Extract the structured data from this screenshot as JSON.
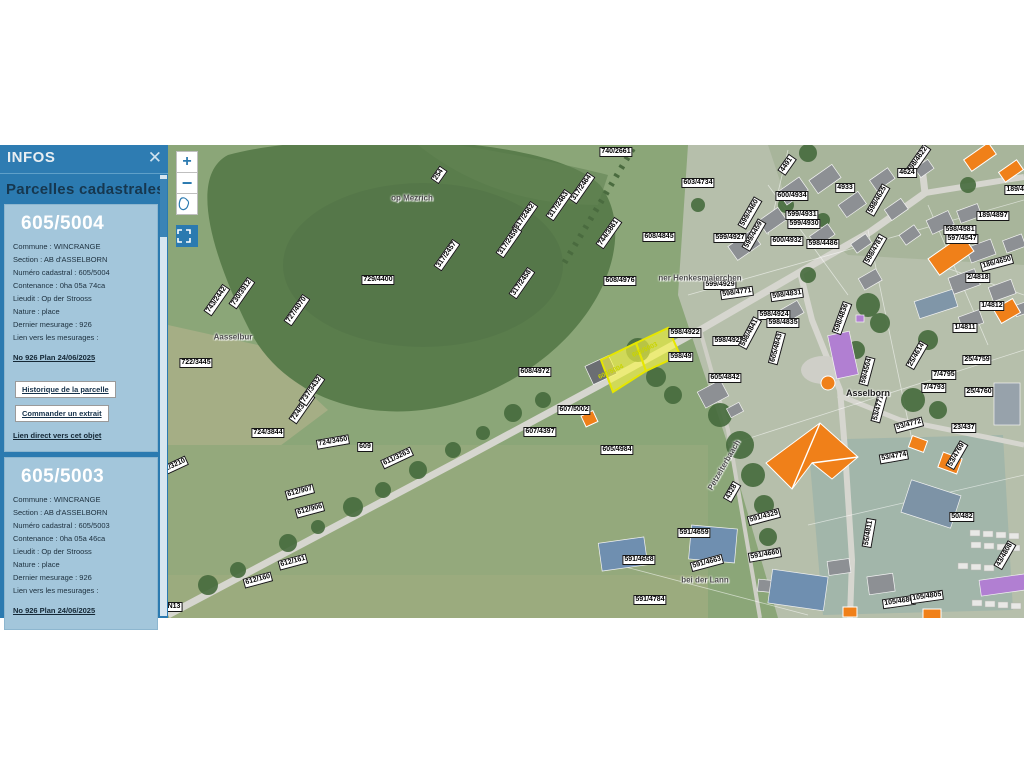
{
  "panel": {
    "header": "INFOS",
    "close_icon": "✕",
    "title": "Parcelles cadastrales",
    "parcels": [
      {
        "id": "605/5004",
        "rows": [
          "Commune : WINCRANGE",
          "Section : AB d'ASSELBORN",
          "Numéro cadastral : 605/5004",
          "Contenance : 0ha 05a 74ca",
          "Lieudit : Op der Strooss",
          "Nature : place",
          "Dernier mesurage : 926",
          "Lien vers les mesurages :"
        ],
        "mesurage_link": "No 926 Plan 24/06/2025",
        "buttons": [
          "Historique de la parcelle",
          "Commander un extrait"
        ],
        "direct_link": "Lien direct vers cet objet"
      },
      {
        "id": "605/5003",
        "rows": [
          "Commune : WINCRANGE",
          "Section : AB d'ASSELBORN",
          "Numéro cadastral : 605/5003",
          "Contenance : 0ha 05a 46ca",
          "Lieudit : Op der Strooss",
          "Nature : place",
          "Dernier mesurage : 926",
          "Lien vers les mesurages :"
        ],
        "mesurage_link": "No 926 Plan 24/06/2025"
      }
    ]
  },
  "map": {
    "controls": {
      "zoom_in": "+",
      "zoom_out": "−"
    },
    "selected_parcels": [
      {
        "label": "605/5004",
        "x": 443,
        "y": 227,
        "r": -25
      },
      {
        "label": "605/5003",
        "x": 477,
        "y": 205,
        "r": -25
      }
    ],
    "labels": [
      {
        "t": "740/2661",
        "x": 448,
        "y": 7,
        "r": 0
      },
      {
        "t": "603/4734",
        "x": 530,
        "y": 38,
        "r": 0
      },
      {
        "t": "608/4845",
        "x": 491,
        "y": 92,
        "r": 0
      },
      {
        "t": "608/4976",
        "x": 452,
        "y": 136,
        "r": 0
      },
      {
        "t": "608/4972",
        "x": 367,
        "y": 227,
        "r": 0
      },
      {
        "t": "607/5002",
        "x": 406,
        "y": 265,
        "r": 0
      },
      {
        "t": "607/4397",
        "x": 372,
        "y": 287,
        "r": 0
      },
      {
        "t": "605/4984",
        "x": 449,
        "y": 305,
        "r": 0
      },
      {
        "t": "605/4842",
        "x": 557,
        "y": 233,
        "r": 0
      },
      {
        "t": "598/4922",
        "x": 517,
        "y": 188,
        "r": 0
      },
      {
        "t": "598/4924",
        "x": 606,
        "y": 170,
        "r": 0
      },
      {
        "t": "598/4925",
        "x": 561,
        "y": 196,
        "r": 0
      },
      {
        "t": "598/49",
        "x": 513,
        "y": 212,
        "r": 0
      },
      {
        "t": "598/4841",
        "x": 582,
        "y": 188,
        "r": -62
      },
      {
        "t": "599/4927",
        "x": 562,
        "y": 93,
        "r": 0
      },
      {
        "t": "599/4460",
        "x": 582,
        "y": 68,
        "r": -60
      },
      {
        "t": "599/4459",
        "x": 586,
        "y": 90,
        "r": -60
      },
      {
        "t": "600/4934",
        "x": 624,
        "y": 51,
        "r": 0
      },
      {
        "t": "599/4931",
        "x": 634,
        "y": 70,
        "r": 0
      },
      {
        "t": "599/4930",
        "x": 636,
        "y": 79,
        "r": 0
      },
      {
        "t": "600/4932",
        "x": 619,
        "y": 96,
        "r": 0
      },
      {
        "t": "598/4486",
        "x": 655,
        "y": 99,
        "r": 0
      },
      {
        "t": "4933",
        "x": 677,
        "y": 43,
        "r": 0
      },
      {
        "t": "4491",
        "x": 619,
        "y": 20,
        "r": -55
      },
      {
        "t": "598/4622",
        "x": 750,
        "y": 15,
        "r": -55
      },
      {
        "t": "4624",
        "x": 739,
        "y": 28,
        "r": 0
      },
      {
        "t": "189/489",
        "x": 851,
        "y": 45,
        "r": 0
      },
      {
        "t": "189/4897",
        "x": 825,
        "y": 71,
        "r": 0
      },
      {
        "t": "598/4581",
        "x": 792,
        "y": 85,
        "r": 0
      },
      {
        "t": "597/4547",
        "x": 794,
        "y": 94,
        "r": 0
      },
      {
        "t": "598/4625",
        "x": 710,
        "y": 55,
        "r": -60
      },
      {
        "t": "598/4781",
        "x": 707,
        "y": 105,
        "r": -60
      },
      {
        "t": "186/4650",
        "x": 829,
        "y": 118,
        "r": -15
      },
      {
        "t": "2/4818",
        "x": 810,
        "y": 133,
        "r": 0
      },
      {
        "t": "1/4812",
        "x": 824,
        "y": 161,
        "r": 0
      },
      {
        "t": "1/4811",
        "x": 797,
        "y": 183,
        "r": 0
      },
      {
        "t": "25/4614",
        "x": 749,
        "y": 210,
        "r": -60
      },
      {
        "t": "25/4759",
        "x": 809,
        "y": 215,
        "r": 0
      },
      {
        "t": "25/4760",
        "x": 811,
        "y": 247,
        "r": 0
      },
      {
        "t": "7/4795",
        "x": 776,
        "y": 230,
        "r": 0
      },
      {
        "t": "7/4793",
        "x": 766,
        "y": 243,
        "r": 0
      },
      {
        "t": "53/4771",
        "x": 711,
        "y": 263,
        "r": -75
      },
      {
        "t": "53/4772",
        "x": 741,
        "y": 280,
        "r": -15
      },
      {
        "t": "23/437",
        "x": 796,
        "y": 283,
        "r": 0
      },
      {
        "t": "53/4774",
        "x": 726,
        "y": 312,
        "r": -10
      },
      {
        "t": "53/4769",
        "x": 789,
        "y": 310,
        "r": -60
      },
      {
        "t": "50/482",
        "x": 794,
        "y": 372,
        "r": 0
      },
      {
        "t": "55/4811",
        "x": 701,
        "y": 388,
        "r": -80
      },
      {
        "t": "105/4680",
        "x": 731,
        "y": 457,
        "r": -8
      },
      {
        "t": "105/4805",
        "x": 759,
        "y": 452,
        "r": -8
      },
      {
        "t": "43/4808",
        "x": 837,
        "y": 410,
        "r": -60
      },
      {
        "t": "591/4329",
        "x": 596,
        "y": 372,
        "r": -15
      },
      {
        "t": "4328",
        "x": 564,
        "y": 347,
        "r": -60
      },
      {
        "t": "591/4659",
        "x": 526,
        "y": 388,
        "r": 0
      },
      {
        "t": "591/4658",
        "x": 471,
        "y": 415,
        "r": 0
      },
      {
        "t": "591/4663",
        "x": 539,
        "y": 418,
        "r": -15
      },
      {
        "t": "591/4660",
        "x": 597,
        "y": 410,
        "r": -10
      },
      {
        "t": "591/4784",
        "x": 482,
        "y": 455,
        "r": 0
      },
      {
        "t": "598/4835",
        "x": 615,
        "y": 178,
        "r": 0
      },
      {
        "t": "598/4836",
        "x": 674,
        "y": 173,
        "r": -70
      },
      {
        "t": "59/4504",
        "x": 699,
        "y": 226,
        "r": -75
      },
      {
        "t": "605/4843",
        "x": 609,
        "y": 203,
        "r": -75
      },
      {
        "t": "599/4929",
        "x": 552,
        "y": 140,
        "r": 0
      },
      {
        "t": "598/4771",
        "x": 569,
        "y": 148,
        "r": -8
      },
      {
        "t": "598/4831",
        "x": 619,
        "y": 150,
        "r": -8
      },
      {
        "t": "724/3844",
        "x": 100,
        "y": 288,
        "r": 0
      },
      {
        "t": "724/3848",
        "x": 134,
        "y": 263,
        "r": -55
      },
      {
        "t": "724/3450",
        "x": 165,
        "y": 297,
        "r": -10
      },
      {
        "t": "609",
        "x": 197,
        "y": 302,
        "r": 0
      },
      {
        "t": "611/3263",
        "x": 229,
        "y": 313,
        "r": -25
      },
      {
        "t": "612/907",
        "x": 132,
        "y": 347,
        "r": -15
      },
      {
        "t": "612/906",
        "x": 142,
        "y": 365,
        "r": -15
      },
      {
        "t": "612/161",
        "x": 125,
        "y": 417,
        "r": -15
      },
      {
        "t": "612/160",
        "x": 90,
        "y": 435,
        "r": -15
      },
      {
        "t": "722/3210",
        "x": 4,
        "y": 322,
        "r": -25
      },
      {
        "t": "722/3445",
        "x": 28,
        "y": 218,
        "r": 0
      },
      {
        "t": "729/4400",
        "x": 210,
        "y": 135,
        "r": 0
      },
      {
        "t": "727/4070",
        "x": 129,
        "y": 165,
        "r": -55
      },
      {
        "t": "743/2442",
        "x": 49,
        "y": 155,
        "r": -55
      },
      {
        "t": "730/3912",
        "x": 74,
        "y": 148,
        "r": -55
      },
      {
        "t": "737/3432",
        "x": 144,
        "y": 245,
        "r": -55
      },
      {
        "t": "317/2464",
        "x": 414,
        "y": 43,
        "r": -55
      },
      {
        "t": "317/2463",
        "x": 391,
        "y": 60,
        "r": -55
      },
      {
        "t": "317/2462",
        "x": 357,
        "y": 72,
        "r": -55
      },
      {
        "t": "317/2459",
        "x": 341,
        "y": 97,
        "r": -55
      },
      {
        "t": "317/2458",
        "x": 354,
        "y": 138,
        "r": -55
      },
      {
        "t": "317/2457",
        "x": 279,
        "y": 110,
        "r": -55
      },
      {
        "t": "744/3861",
        "x": 441,
        "y": 88,
        "r": -55
      },
      {
        "t": "254",
        "x": 271,
        "y": 30,
        "r": -55
      },
      {
        "t": "N13",
        "x": 6,
        "y": 462,
        "r": 0
      }
    ],
    "places": [
      {
        "t": "op Mezrich",
        "x": 244,
        "y": 53,
        "r": 0,
        "style": "gray"
      },
      {
        "t": "Aasselbur",
        "x": 65,
        "y": 192,
        "r": 0,
        "style": "gray"
      },
      {
        "t": "Asselborn",
        "x": 700,
        "y": 248,
        "r": 0,
        "style": "black"
      },
      {
        "t": "bei der Lann",
        "x": 537,
        "y": 435,
        "r": 0,
        "style": "gray"
      },
      {
        "t": "ner Henkesmaierchen",
        "x": 532,
        "y": 133,
        "r": 0,
        "style": "gray"
      },
      {
        "t": "Pëtzelterbaach",
        "x": 556,
        "y": 320,
        "r": -60,
        "style": "gray"
      }
    ]
  },
  "colors": {
    "panel_blue": "#2b7ab0",
    "panel_card": "#a3c6db",
    "heading_dark": "#16374f",
    "selection_yellow": "#f6f23c",
    "selection_border": "#e6e600",
    "building_orange": "#f08019",
    "building_purple": "#b17fd2",
    "road_gray": "#d6d6cf"
  }
}
